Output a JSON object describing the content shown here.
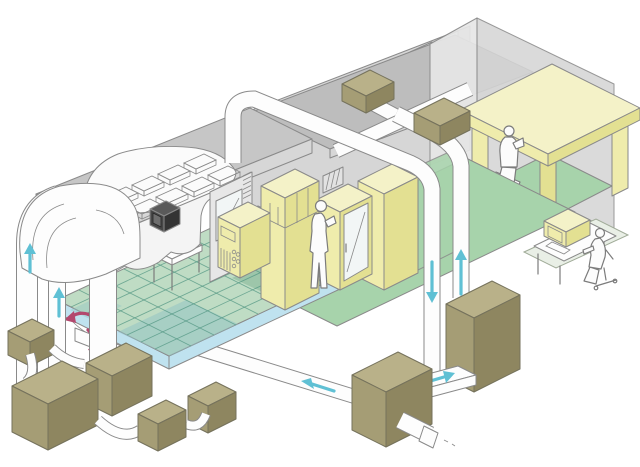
{
  "scene": {
    "type": "isometric-cutaway-diagram",
    "subject": "cleanroom-hvac-airflow-system"
  },
  "colors": {
    "background": "#ffffff",
    "outline": "#8a8a8a",
    "outline_dark": "#75725c",
    "wall": "#d6d6d6",
    "wall_light": "#e7e7e7",
    "wall_torn": "#f4f4f4",
    "roof": "#bdbdbd",
    "ceiling_top": "#c6c6c6",
    "ceiling_front": "#d7d7d7",
    "floor_green": "#a7d3ab",
    "floor_grid_green": "#bfdcc4",
    "grid_line": "#4e9480",
    "patch_teal": "#8fc2c4",
    "patch_green": "#74ab8c",
    "plenum_blue": "#bfe2ef",
    "equipment_yellow_top": "#f4f2c8",
    "equipment_yellow_front": "#efecac",
    "equipment_yellow_side": "#e3e092",
    "khaki_top": "#b9b189",
    "khaki_front": "#a59d75",
    "khaki_side": "#8e8660",
    "duct_white": "#fdfdfd",
    "glass": "#f2f6f6",
    "arrow_cyan": "#5fc0d4",
    "arrow_magenta": "#b3486e",
    "control_box": "#4a4a4a",
    "person": "#fcfcfc",
    "mat": "#e9efe6"
  },
  "components": [
    {
      "name": "cleanroom-ceiling-plenum"
    },
    {
      "name": "hepa-filter-grid",
      "filter_count": 8
    },
    {
      "name": "return-air-hood"
    },
    {
      "name": "return-riser-ducts",
      "count": 3
    },
    {
      "name": "raised-grid-floor"
    },
    {
      "name": "underfloor-plenum"
    },
    {
      "name": "floor-table"
    },
    {
      "name": "control-box"
    },
    {
      "name": "equipment-room"
    },
    {
      "name": "process-cabinets",
      "count": 4
    },
    {
      "name": "standing-person"
    },
    {
      "name": "wall-vent"
    },
    {
      "name": "office-room",
      "window_count": 4
    },
    {
      "name": "office-desk"
    },
    {
      "name": "seated-person"
    },
    {
      "name": "rooftop-duct-network"
    },
    {
      "name": "rooftop-fan-boxes",
      "count": 2
    },
    {
      "name": "supply-drop-duct"
    },
    {
      "name": "return-drop-duct"
    },
    {
      "name": "air-handling-unit-a"
    },
    {
      "name": "air-handling-unit-b"
    },
    {
      "name": "auxiliary-unit-boxes",
      "count": 5
    },
    {
      "name": "flex-ducts",
      "count": 4
    },
    {
      "name": "monitoring-station"
    },
    {
      "name": "monitoring-person"
    }
  ],
  "airflow": {
    "cyan_arrows": [
      {
        "id": "left-riser-1",
        "direction": "up"
      },
      {
        "id": "left-riser-2",
        "direction": "up"
      },
      {
        "id": "right-drop-duct",
        "direction": "down"
      },
      {
        "id": "right-return-duct",
        "direction": "up"
      },
      {
        "id": "ahu-crossover",
        "direction": "right"
      },
      {
        "id": "underfloor-supply",
        "direction": "left"
      }
    ],
    "magenta_arrows": [
      {
        "id": "underfloor-recirculation-1",
        "direction": "down-left"
      },
      {
        "id": "underfloor-recirculation-2",
        "direction": "down"
      }
    ]
  }
}
